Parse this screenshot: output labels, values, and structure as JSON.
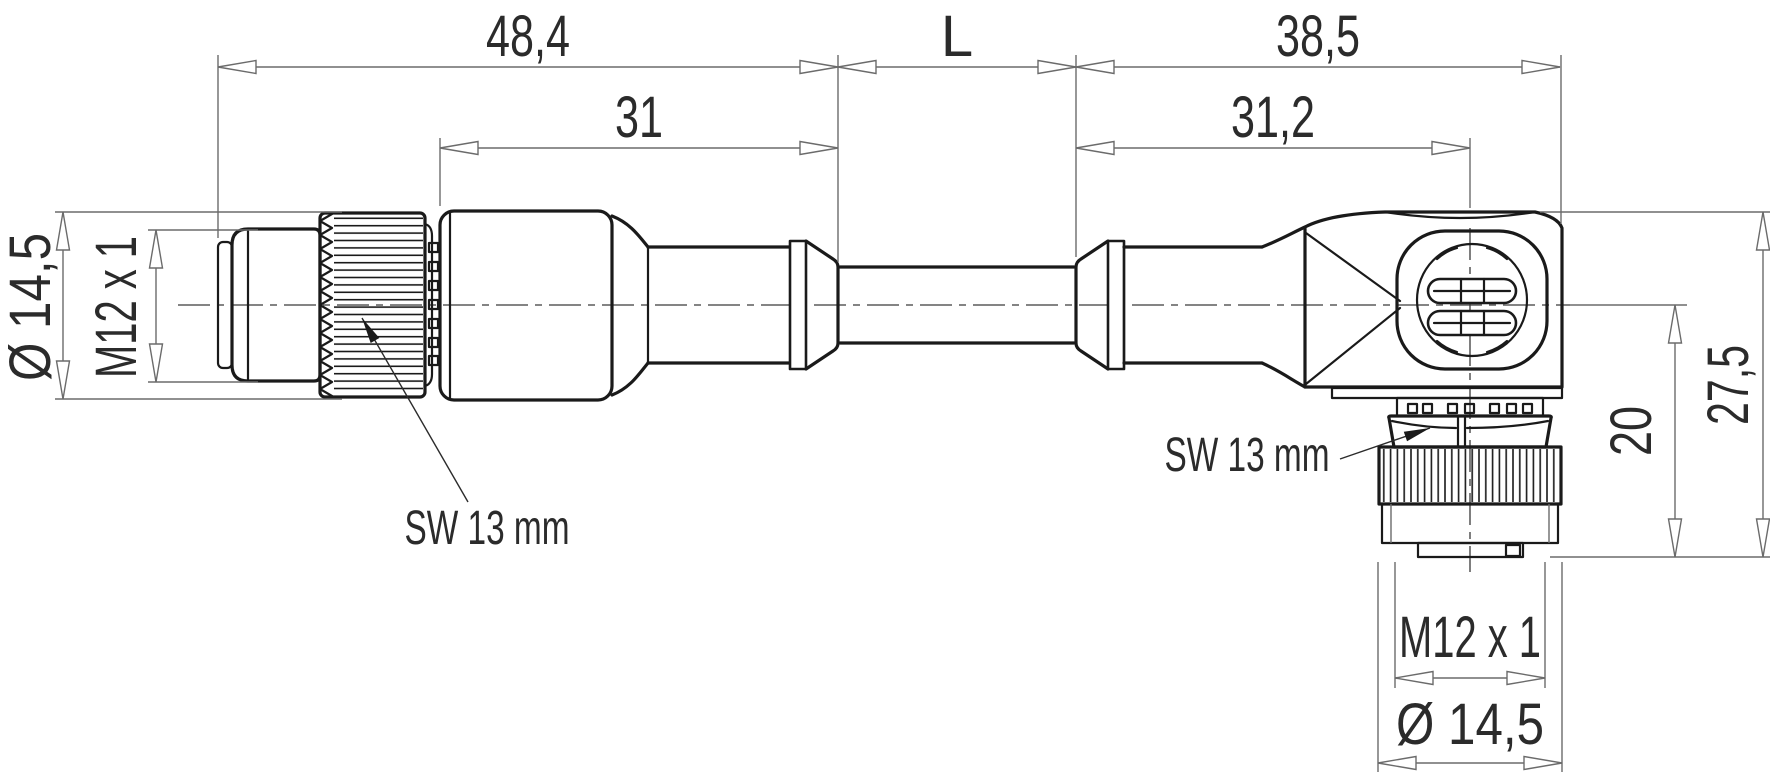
{
  "drawing": {
    "dimensions": {
      "row1": [
        "48,4",
        "L",
        "38,5"
      ],
      "row2": [
        "31",
        "31,2"
      ],
      "left": {
        "outer_diameter": "Ø 14,5",
        "thread": "M12 x 1"
      },
      "right": {
        "height_total": "27,5",
        "height_center": "20"
      },
      "bottom": {
        "thread": "M12 x 1",
        "outer_diameter": "Ø 14,5"
      },
      "wrench_left": "SW 13 mm",
      "wrench_right": "SW 13 mm"
    },
    "colors": {
      "outline": "#1a1a1a",
      "dimension": "#6b6b6b",
      "text": "#2b2b2b",
      "background": "#ffffff"
    }
  }
}
